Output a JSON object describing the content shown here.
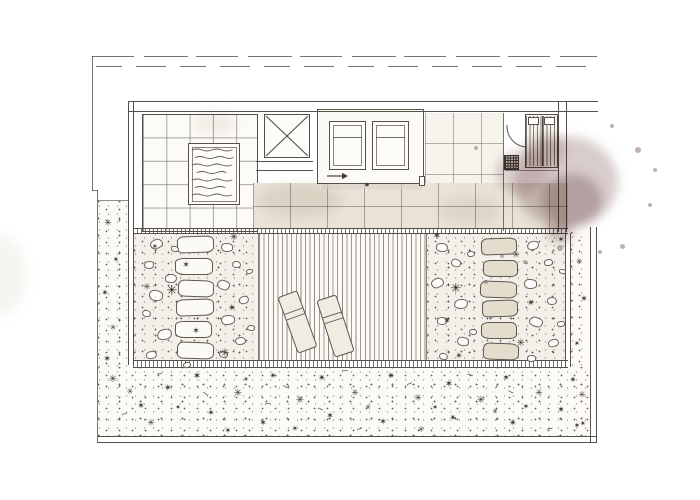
{
  "document": {
    "visible_text": ""
  },
  "colors": {
    "line": "#55504a",
    "line-soft": "#8a847b",
    "tile": "#e8e2d7",
    "gravel": "#f3f0e9",
    "garden": "#fbfaf6",
    "stone-tint": "#e4ddce",
    "stain": "#967272"
  },
  "scene": {
    "plant_glyphs": [
      "✳",
      "✶",
      "✴",
      "*"
    ],
    "stone_radii": [
      "18% 22% 20% 16% / 30% 26% 34% 28%",
      "22% 16% 18% 24% / 26% 34% 28% 30%",
      "16% 24% 22% 18% / 34% 28% 30% 26%"
    ],
    "pebble_radii": [
      "55% 45% 60% 40% / 50% 60% 45% 55%",
      "45% 55% 40% 60% / 60% 40% 55% 45%",
      "60% 50% 45% 55% / 45% 55% 60% 40%",
      "40% 60% 55% 45% / 55% 45% 40% 60%"
    ],
    "stepping_stones": [
      {
        "x": 177,
        "y": 236,
        "w": 37,
        "h": 17,
        "t": 0
      },
      {
        "x": 175,
        "y": 258,
        "w": 38,
        "h": 17,
        "t": 0
      },
      {
        "x": 178,
        "y": 280,
        "w": 36,
        "h": 17,
        "t": 0
      },
      {
        "x": 176,
        "y": 299,
        "w": 38,
        "h": 17,
        "t": 0
      },
      {
        "x": 175,
        "y": 321,
        "w": 37,
        "h": 17,
        "t": 0
      },
      {
        "x": 177,
        "y": 342,
        "w": 37,
        "h": 17,
        "t": 0
      },
      {
        "x": 481,
        "y": 238,
        "w": 36,
        "h": 17,
        "t": 1
      },
      {
        "x": 483,
        "y": 260,
        "w": 35,
        "h": 17,
        "t": 1
      },
      {
        "x": 480,
        "y": 281,
        "w": 37,
        "h": 17,
        "t": 1
      },
      {
        "x": 482,
        "y": 300,
        "w": 36,
        "h": 17,
        "t": 1
      },
      {
        "x": 481,
        "y": 322,
        "w": 36,
        "h": 17,
        "t": 1
      },
      {
        "x": 483,
        "y": 343,
        "w": 36,
        "h": 17,
        "t": 1
      }
    ],
    "pebbles": [
      {
        "x": 150,
        "y": 239,
        "w": 13,
        "h": 10
      },
      {
        "x": 144,
        "y": 261,
        "w": 10,
        "h": 8
      },
      {
        "x": 165,
        "y": 274,
        "w": 12,
        "h": 9
      },
      {
        "x": 149,
        "y": 290,
        "w": 14,
        "h": 11
      },
      {
        "x": 142,
        "y": 310,
        "w": 9,
        "h": 7
      },
      {
        "x": 157,
        "y": 329,
        "w": 15,
        "h": 11
      },
      {
        "x": 146,
        "y": 351,
        "w": 11,
        "h": 8
      },
      {
        "x": 221,
        "y": 243,
        "w": 12,
        "h": 9
      },
      {
        "x": 232,
        "y": 261,
        "w": 9,
        "h": 7
      },
      {
        "x": 217,
        "y": 280,
        "w": 13,
        "h": 10
      },
      {
        "x": 239,
        "y": 296,
        "w": 10,
        "h": 8
      },
      {
        "x": 221,
        "y": 315,
        "w": 14,
        "h": 10
      },
      {
        "x": 235,
        "y": 337,
        "w": 11,
        "h": 8
      },
      {
        "x": 219,
        "y": 351,
        "w": 9,
        "h": 7
      },
      {
        "x": 171,
        "y": 246,
        "w": 8,
        "h": 6
      },
      {
        "x": 183,
        "y": 362,
        "w": 8,
        "h": 6
      },
      {
        "x": 246,
        "y": 269,
        "w": 7,
        "h": 5
      },
      {
        "x": 247,
        "y": 325,
        "w": 8,
        "h": 6
      },
      {
        "x": 436,
        "y": 243,
        "w": 12,
        "h": 9
      },
      {
        "x": 451,
        "y": 259,
        "w": 10,
        "h": 8
      },
      {
        "x": 431,
        "y": 278,
        "w": 13,
        "h": 10
      },
      {
        "x": 454,
        "y": 299,
        "w": 14,
        "h": 10
      },
      {
        "x": 437,
        "y": 317,
        "w": 10,
        "h": 8
      },
      {
        "x": 457,
        "y": 337,
        "w": 12,
        "h": 9
      },
      {
        "x": 439,
        "y": 353,
        "w": 9,
        "h": 7
      },
      {
        "x": 527,
        "y": 241,
        "w": 12,
        "h": 9
      },
      {
        "x": 544,
        "y": 259,
        "w": 9,
        "h": 7
      },
      {
        "x": 524,
        "y": 279,
        "w": 13,
        "h": 10
      },
      {
        "x": 547,
        "y": 297,
        "w": 10,
        "h": 8
      },
      {
        "x": 529,
        "y": 317,
        "w": 14,
        "h": 10
      },
      {
        "x": 548,
        "y": 339,
        "w": 11,
        "h": 8
      },
      {
        "x": 527,
        "y": 355,
        "w": 9,
        "h": 7
      },
      {
        "x": 467,
        "y": 251,
        "w": 8,
        "h": 6
      },
      {
        "x": 469,
        "y": 329,
        "w": 8,
        "h": 6
      },
      {
        "x": 559,
        "y": 269,
        "w": 7,
        "h": 5
      },
      {
        "x": 557,
        "y": 321,
        "w": 8,
        "h": 6
      }
    ],
    "plants": [
      {
        "x": 234,
        "y": 238,
        "s": 10,
        "t": 0
      },
      {
        "x": 186,
        "y": 266,
        "s": 9,
        "t": 1
      },
      {
        "x": 147,
        "y": 288,
        "s": 9,
        "t": 0
      },
      {
        "x": 172,
        "y": 291,
        "s": 13,
        "t": 0,
        "d": 1
      },
      {
        "x": 232,
        "y": 309,
        "s": 10,
        "t": 2
      },
      {
        "x": 196,
        "y": 332,
        "s": 9,
        "t": 1
      },
      {
        "x": 225,
        "y": 353,
        "s": 11,
        "t": 0
      },
      {
        "x": 155,
        "y": 247,
        "s": 8,
        "t": 2
      },
      {
        "x": 437,
        "y": 237,
        "s": 10,
        "t": 1
      },
      {
        "x": 516,
        "y": 256,
        "s": 9,
        "t": 0
      },
      {
        "x": 456,
        "y": 289,
        "s": 13,
        "t": 0,
        "d": 1
      },
      {
        "x": 531,
        "y": 304,
        "s": 10,
        "t": 2
      },
      {
        "x": 447,
        "y": 322,
        "s": 9,
        "t": 1
      },
      {
        "x": 521,
        "y": 344,
        "s": 10,
        "t": 0
      },
      {
        "x": 459,
        "y": 357,
        "s": 9,
        "t": 2
      },
      {
        "x": 561,
        "y": 240,
        "s": 8,
        "t": 1
      },
      {
        "x": 108,
        "y": 224,
        "s": 9,
        "t": 0
      },
      {
        "x": 116,
        "y": 260,
        "s": 8,
        "t": 1
      },
      {
        "x": 105,
        "y": 294,
        "s": 9,
        "t": 2
      },
      {
        "x": 113,
        "y": 328,
        "s": 8,
        "t": 0
      },
      {
        "x": 107,
        "y": 360,
        "s": 9,
        "t": 1
      },
      {
        "x": 579,
        "y": 262,
        "s": 8,
        "t": 0
      },
      {
        "x": 584,
        "y": 300,
        "s": 9,
        "t": 1
      },
      {
        "x": 577,
        "y": 344,
        "s": 8,
        "t": 2
      },
      {
        "x": 582,
        "y": 396,
        "s": 9,
        "t": 0
      },
      {
        "x": 577,
        "y": 426,
        "s": 8,
        "t": 1
      },
      {
        "x": 113,
        "y": 380,
        "s": 10,
        "t": 0
      },
      {
        "x": 141,
        "y": 407,
        "s": 9,
        "t": 1
      },
      {
        "x": 168,
        "y": 389,
        "s": 10,
        "t": 2
      },
      {
        "x": 151,
        "y": 424,
        "s": 9,
        "t": 0
      },
      {
        "x": 197,
        "y": 377,
        "s": 10,
        "t": 1
      },
      {
        "x": 211,
        "y": 414,
        "s": 9,
        "t": 2
      },
      {
        "x": 238,
        "y": 394,
        "s": 10,
        "t": 0
      },
      {
        "x": 263,
        "y": 424,
        "s": 9,
        "t": 1
      },
      {
        "x": 273,
        "y": 377,
        "s": 9,
        "t": 2
      },
      {
        "x": 300,
        "y": 401,
        "s": 10,
        "t": 0
      },
      {
        "x": 330,
        "y": 417,
        "s": 9,
        "t": 1
      },
      {
        "x": 322,
        "y": 379,
        "s": 10,
        "t": 2
      },
      {
        "x": 355,
        "y": 394,
        "s": 9,
        "t": 0
      },
      {
        "x": 383,
        "y": 423,
        "s": 9,
        "t": 1
      },
      {
        "x": 391,
        "y": 377,
        "s": 10,
        "t": 2
      },
      {
        "x": 418,
        "y": 399,
        "s": 9,
        "t": 0
      },
      {
        "x": 449,
        "y": 385,
        "s": 10,
        "t": 1
      },
      {
        "x": 453,
        "y": 419,
        "s": 9,
        "t": 2
      },
      {
        "x": 481,
        "y": 401,
        "s": 10,
        "t": 0
      },
      {
        "x": 506,
        "y": 379,
        "s": 9,
        "t": 1
      },
      {
        "x": 513,
        "y": 424,
        "s": 10,
        "t": 2
      },
      {
        "x": 539,
        "y": 394,
        "s": 9,
        "t": 0
      },
      {
        "x": 561,
        "y": 411,
        "s": 9,
        "t": 1
      },
      {
        "x": 573,
        "y": 381,
        "s": 9,
        "t": 2
      },
      {
        "x": 130,
        "y": 392,
        "s": 8,
        "t": 0
      },
      {
        "x": 228,
        "y": 431,
        "s": 8,
        "t": 1
      },
      {
        "x": 295,
        "y": 429,
        "s": 8,
        "t": 2
      },
      {
        "x": 421,
        "y": 430,
        "s": 8,
        "t": 0
      },
      {
        "x": 526,
        "y": 407,
        "s": 8,
        "t": 1
      },
      {
        "x": 583,
        "y": 424,
        "s": 8,
        "t": 2
      },
      {
        "x": 178,
        "y": 408,
        "s": 7,
        "t": 1
      },
      {
        "x": 246,
        "y": 380,
        "s": 7,
        "t": 2
      },
      {
        "x": 368,
        "y": 408,
        "s": 7,
        "t": 0
      },
      {
        "x": 435,
        "y": 408,
        "s": 7,
        "t": 1
      },
      {
        "x": 495,
        "y": 412,
        "s": 7,
        "t": 0
      }
    ],
    "squiggles": [
      {
        "x": 160,
        "y": 375,
        "r": -15
      },
      {
        "x": 285,
        "y": 388,
        "r": 20
      },
      {
        "x": 360,
        "y": 430,
        "r": -25
      },
      {
        "x": 470,
        "y": 376,
        "r": 10
      },
      {
        "x": 550,
        "y": 430,
        "r": -10
      },
      {
        "x": 205,
        "y": 395,
        "r": 30
      },
      {
        "x": 125,
        "y": 415,
        "r": -20
      },
      {
        "x": 320,
        "y": 410,
        "r": 15
      },
      {
        "x": 410,
        "y": 385,
        "r": -30
      },
      {
        "x": 510,
        "y": 393,
        "r": 25
      },
      {
        "x": 345,
        "y": 372,
        "r": 0
      },
      {
        "x": 268,
        "y": 405,
        "r": -12
      }
    ],
    "loungers": [
      {
        "x": 287,
        "y": 292,
        "w": 21,
        "h": 60,
        "a": -20
      },
      {
        "x": 325,
        "y": 296,
        "w": 21,
        "h": 60,
        "a": -18
      }
    ],
    "spatter": [
      {
        "x": 638,
        "y": 150,
        "r": 3
      },
      {
        "x": 655,
        "y": 170,
        "r": 2
      },
      {
        "x": 622,
        "y": 246,
        "r": 2.5
      },
      {
        "x": 502,
        "y": 256,
        "r": 2
      },
      {
        "x": 476,
        "y": 148,
        "r": 2
      },
      {
        "x": 650,
        "y": 205,
        "r": 2.2
      },
      {
        "x": 600,
        "y": 252,
        "r": 2
      },
      {
        "x": 560,
        "y": 248,
        "r": 3
      },
      {
        "x": 612,
        "y": 126,
        "r": 2
      },
      {
        "x": 486,
        "y": 282,
        "r": 1.6
      },
      {
        "x": 470,
        "y": 250,
        "r": 1.4
      },
      {
        "x": 525,
        "y": 262,
        "r": 1.8
      }
    ]
  }
}
